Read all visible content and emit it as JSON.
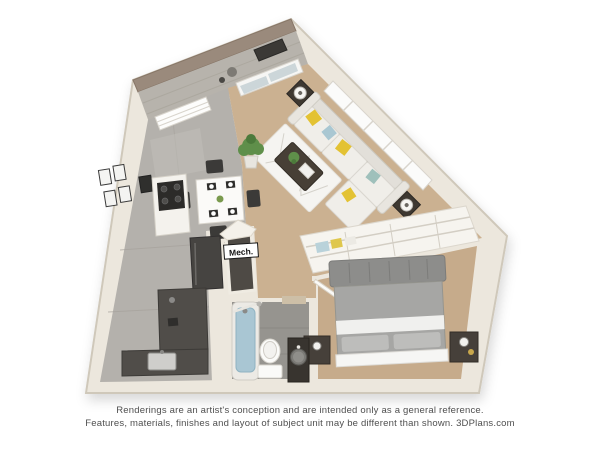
{
  "floor_plan": {
    "type_note": "3D one-bedroom apartment floor plan rendering",
    "mech_label": "Mech.",
    "rooms": [
      "kitchen-dining",
      "living-room",
      "bedroom",
      "bathroom",
      "mechanical-closet",
      "walk-in-closet",
      "balcony"
    ]
  },
  "disclaimer": {
    "line1": "Renderings are an artist's conception and are intended only as a general reference.",
    "line2": "Features, materials, finishes and layout of subject unit may be different than shown. 3DPlans.com"
  },
  "palette": {
    "background": "#ffffff",
    "wall_cream": "#ece7dd",
    "wall_edge": "#cfc8ba",
    "balcony_railing_taupe": "#9a8a7c",
    "balcony_floor_gray": "#b7b3ac",
    "kitchen_tile_gray": "#b4b1ac",
    "carpet_tan": "#c9ae8e",
    "bathroom_tile_gray": "#96948f",
    "counter_dark": "#504d49",
    "tub_water_blue": "#a9c6d3",
    "sofa_light": "#f0eee9",
    "pillow_yellow": "#e3c233",
    "pillow_blue": "#a9c7d2",
    "bed_gray": "#a6a6a4",
    "plant_green": "#5f8f4a",
    "text_gray": "#4f4f4f"
  }
}
